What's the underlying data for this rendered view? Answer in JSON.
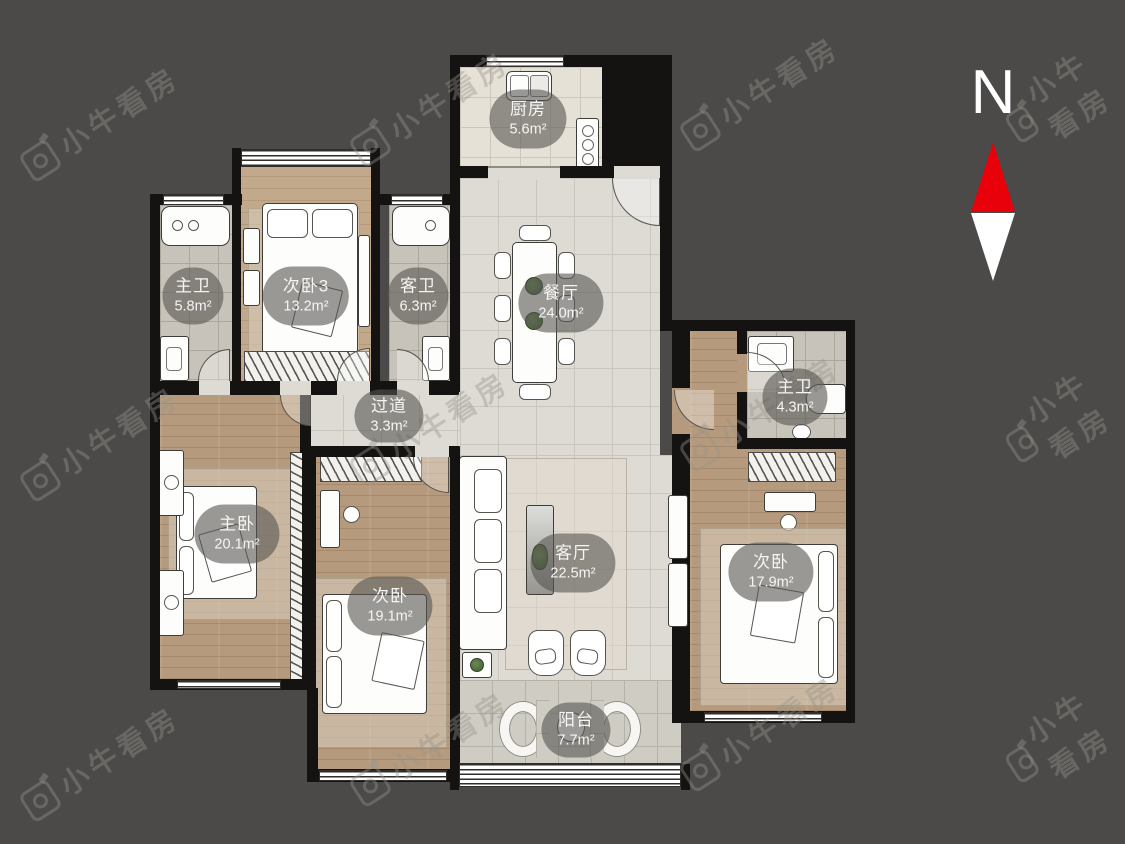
{
  "colors": {
    "background": "#4b4a48",
    "wall": "#141311",
    "north_red": "#e8000a",
    "north_white": "#ffffff"
  },
  "compass": {
    "label": "N"
  },
  "watermark": {
    "text": "小牛看房",
    "logo": "camera-icon"
  },
  "rooms": [
    {
      "id": "kitchen",
      "name": "厨房",
      "area": "5.6m²"
    },
    {
      "id": "master-bath-left",
      "name": "主卫",
      "area": "5.8m²"
    },
    {
      "id": "bedroom-3",
      "name": "次卧3",
      "area": "13.2m²"
    },
    {
      "id": "guest-bath",
      "name": "客卫",
      "area": "6.3m²"
    },
    {
      "id": "dining-room",
      "name": "餐厅",
      "area": "24.0m²"
    },
    {
      "id": "master-bath-right",
      "name": "主卫",
      "area": "4.3m²"
    },
    {
      "id": "hallway",
      "name": "过道",
      "area": "3.3m²"
    },
    {
      "id": "master-bedroom",
      "name": "主卧",
      "area": "20.1m²"
    },
    {
      "id": "second-bedroom",
      "name": "次卧",
      "area": "19.1m²"
    },
    {
      "id": "living-room",
      "name": "客厅",
      "area": "22.5m²"
    },
    {
      "id": "right-bedroom",
      "name": "次卧",
      "area": "17.9m²"
    },
    {
      "id": "balcony",
      "name": "阳台",
      "area": "7.7m²"
    }
  ]
}
